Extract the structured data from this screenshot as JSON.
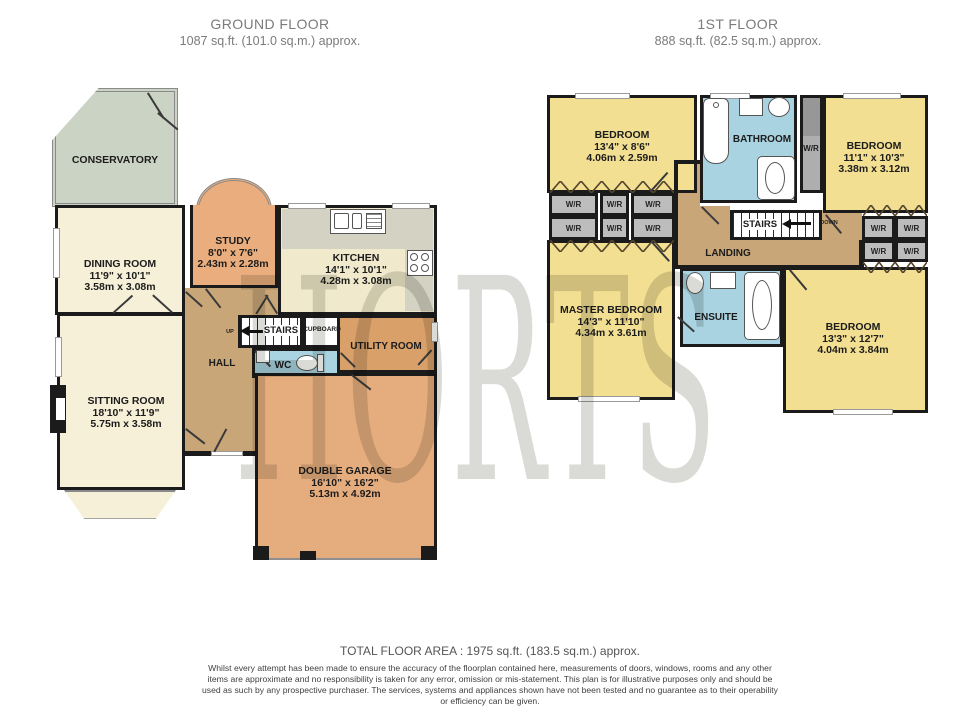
{
  "watermark": {
    "text": "HORTS"
  },
  "headers": {
    "ground": {
      "title": "GROUND FLOOR",
      "area": "1087 sq.ft. (101.0 sq.m.) approx."
    },
    "first": {
      "title": "1ST FLOOR",
      "area": "888 sq.ft. (82.5 sq.m.) approx."
    }
  },
  "ground": {
    "conservatory": {
      "name": "CONSERVATORY"
    },
    "dining": {
      "name": "DINING ROOM",
      "imperial": "11'9\" x 10'1\"",
      "metric": "3.58m x 3.08m"
    },
    "study": {
      "name": "STUDY",
      "imperial": "8'0\" x 7'6\"",
      "metric": "2.43m x 2.28m"
    },
    "kitchen": {
      "name": "KITCHEN",
      "imperial": "14'1\" x 10'1\"",
      "metric": "4.28m x 3.08m"
    },
    "sitting": {
      "name": "SITTING ROOM",
      "imperial": "18'10\" x 11'9\"",
      "metric": "5.75m x 3.58m"
    },
    "hall": {
      "name": "HALL"
    },
    "stairs": {
      "name": "STAIRS",
      "direction": "UP"
    },
    "cupboard": {
      "name": "CUPBOARD"
    },
    "wc": {
      "name": "WC"
    },
    "utility": {
      "name": "UTILITY ROOM"
    },
    "garage": {
      "name": "DOUBLE GARAGE",
      "imperial": "16'10\" x 16'2\"",
      "metric": "5.13m x 4.92m"
    }
  },
  "first": {
    "bedroom1": {
      "name": "BEDROOM",
      "imperial": "13'4\" x 8'6\"",
      "metric": "4.06m x 2.59m"
    },
    "bathroom": {
      "name": "BATHROOM"
    },
    "wardrobe": {
      "label": "W/R"
    },
    "bedroom2": {
      "name": "BEDROOM",
      "imperial": "11'1\" x 10'3\"",
      "metric": "3.38m x 3.12m"
    },
    "stairs": {
      "name": "STAIRS",
      "direction": "DOWN"
    },
    "landing": {
      "name": "LANDING"
    },
    "master": {
      "name": "MASTER BEDROOM",
      "imperial": "14'3\" x 11'10\"",
      "metric": "4.34m x 3.61m"
    },
    "ensuite": {
      "name": "ENSUITE"
    },
    "bedroom3": {
      "name": "BEDROOM",
      "imperial": "13'3\" x 12'7\"",
      "metric": "4.04m x 3.84m"
    }
  },
  "footer": {
    "total": "TOTAL FLOOR AREA : 1975 sq.ft. (183.5 sq.m.) approx.",
    "disclaimer": "Whilst every attempt has been made to ensure the accuracy of the floorplan contained here, measurements of doors, windows, rooms and any other items are approximate and no responsibility is taken for any error, omission or mis-statement. This plan is for illustrative purposes only and should be used as such by any prospective purchaser. The services, systems and appliances shown have not been tested and no guarantee as to their operability or efficiency can be given.",
    "credit": "Made with Metropix ©2026"
  },
  "colors": {
    "wall": "#1b1b1b",
    "cream_room": "#f6f0d8",
    "bedroom_yellow": "#f2df92",
    "wet_room_blue": "#a9d3e1",
    "hall_tan": "#c8a678",
    "garage_orange": "#e5ad7e",
    "study_orange": "#eaae7e",
    "utility_orange": "#d9a06a",
    "kitchen_cream": "#f0e9cc",
    "counter_grey": "#d4d2c3",
    "conservatory_green": "#cbd3c5",
    "wardrobe_grey": "#bdbdbd"
  }
}
